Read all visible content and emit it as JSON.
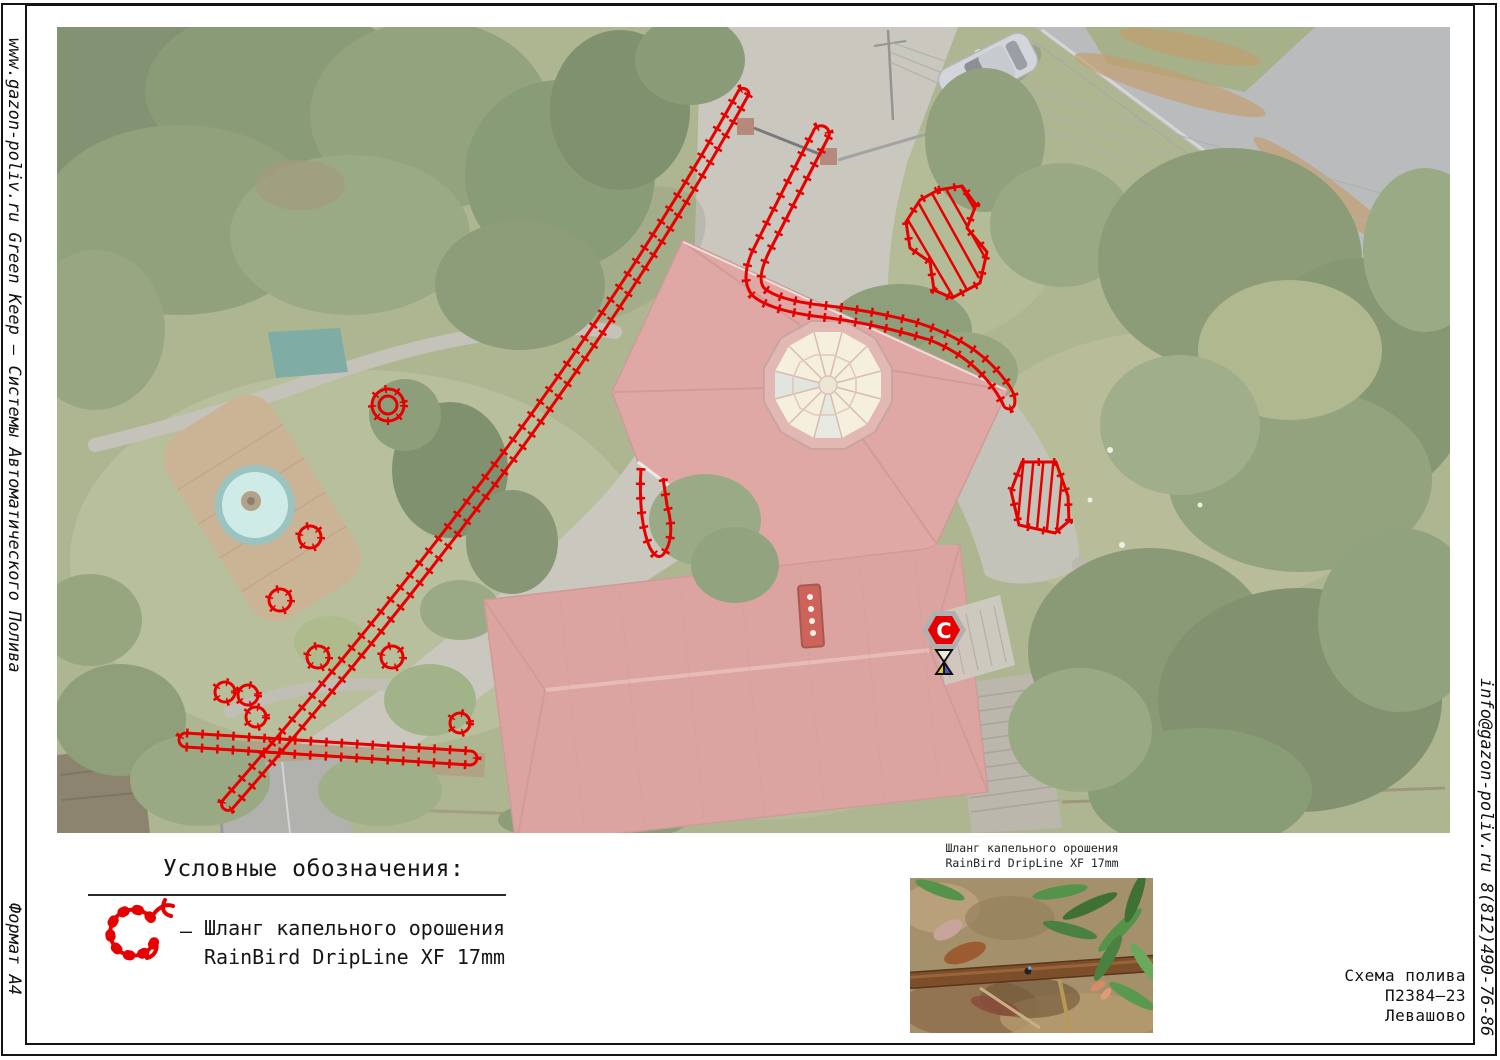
{
  "frame": {
    "left_text": "www.gazon-poliv.ru  Green Keep  –  Системы Автоматического Полива",
    "format_label": "Формат А4",
    "right_text": "info@gazon-poliv.ru  8(812)490-76-86"
  },
  "legend": {
    "title": "Условные обозначения:",
    "dash": "–",
    "line1": "Шланг капельного орошения",
    "line2": "RainBird DripLine XF 17mm"
  },
  "inset": {
    "caption1": "Шланг капельного орошения",
    "caption2": "RainBird DripLine XF 17mm"
  },
  "title_block": {
    "line1": "Схема полива",
    "line2": "П2384—23",
    "line3": "Левашово"
  },
  "map": {
    "controller_label": "С",
    "colors": {
      "drip_line": "#e60000",
      "roof": "#d68e8a",
      "dome": "#f2ecd4",
      "lawn": "#97a273",
      "asphalt": "#a6a8aa",
      "pavement": "#bcb8ae",
      "pool_water": "#c2e6e2"
    }
  }
}
